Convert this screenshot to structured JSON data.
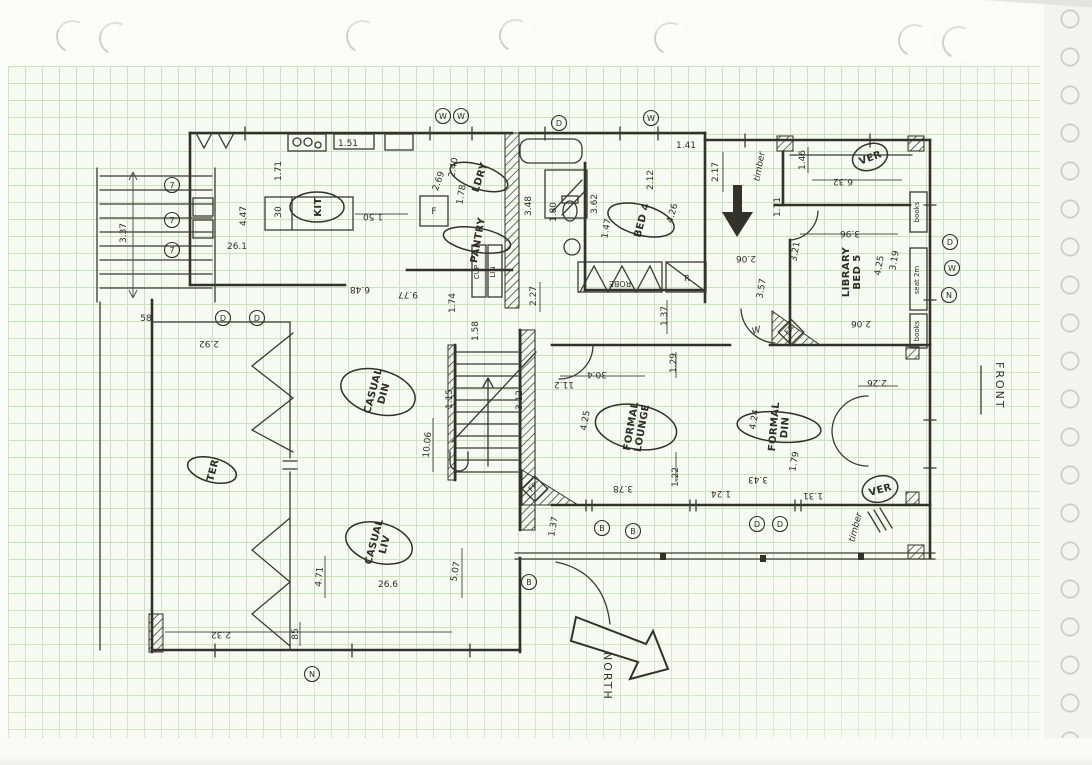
{
  "colors": {
    "ink": "#32322b",
    "grid_line": "#c9e4bc",
    "paper": "#fbfbf8"
  },
  "annotations": {
    "front": "FRONT",
    "north": "NORTH"
  },
  "rooms": [
    {
      "label": "KIT",
      "x": 317,
      "y": 207,
      "r": -90,
      "ellipse": [
        15,
        27
      ]
    },
    {
      "label": "LDRY",
      "x": 479,
      "y": 177,
      "r": -72,
      "ellipse": [
        12,
        30
      ]
    },
    {
      "label": "PANTRY",
      "x": 477,
      "y": 240,
      "r": -80,
      "ellipse": [
        12,
        34
      ]
    },
    {
      "label": "BED 4",
      "x": 641,
      "y": 220,
      "r": -75,
      "ellipse": [
        15,
        34
      ]
    },
    {
      "lines": [
        "LIBRARY",
        "BED 5"
      ],
      "x": 851,
      "y": 272,
      "r": -90
    },
    {
      "label": "VER",
      "x": 870,
      "y": 157,
      "r": -20,
      "ellipse": [
        18,
        13
      ]
    },
    {
      "label": "TER",
      "x": 212,
      "y": 470,
      "r": -75,
      "ellipse": [
        12,
        25
      ]
    },
    {
      "lines": [
        "CASUAL",
        "DIN"
      ],
      "x": 378,
      "y": 392,
      "r": -75,
      "ellipse": [
        22,
        38
      ]
    },
    {
      "lines": [
        "CASUAL",
        "LIV"
      ],
      "x": 379,
      "y": 543,
      "r": -75,
      "ellipse": [
        20,
        34
      ]
    },
    {
      "lines": [
        "FORMAL",
        "LOUNGE"
      ],
      "x": 636,
      "y": 427,
      "r": -80,
      "ellipse": [
        22,
        41
      ]
    },
    {
      "lines": [
        "FORMAL",
        "DIN"
      ],
      "x": 779,
      "y": 427,
      "r": -85,
      "ellipse": [
        15,
        42
      ]
    },
    {
      "label": "VER",
      "x": 880,
      "y": 489,
      "r": -15,
      "ellipse": [
        18,
        13
      ]
    }
  ],
  "fixtures": [
    {
      "t": "F",
      "x": 434,
      "y": 214,
      "r": 0,
      "s": 9
    },
    {
      "t": "CUP",
      "x": 479,
      "y": 272,
      "r": -90,
      "s": 7
    },
    {
      "t": "LIN",
      "x": 495,
      "y": 272,
      "r": -90,
      "s": 7
    },
    {
      "t": "ROBE",
      "x": 620,
      "y": 281,
      "r": 180,
      "s": 8
    },
    {
      "t": "R.",
      "x": 688,
      "y": 281,
      "r": 0,
      "s": 8
    },
    {
      "t": "books",
      "x": 919,
      "y": 212,
      "r": -90,
      "s": 7
    },
    {
      "t": "seat 2m",
      "x": 919,
      "y": 280,
      "r": -90,
      "s": 7
    },
    {
      "t": "books",
      "x": 919,
      "y": 331,
      "r": -90,
      "s": 7
    },
    {
      "t": "FP",
      "x": 535,
      "y": 489,
      "r": -45,
      "s": 8
    },
    {
      "t": "FP",
      "x": 791,
      "y": 332,
      "r": -45,
      "s": 8
    },
    {
      "t": "W",
      "x": 757,
      "y": 333,
      "r": -15,
      "s": 9,
      "i": 1
    },
    {
      "t": "timber",
      "x": 762,
      "y": 167,
      "r": -80,
      "s": 9,
      "i": 1
    },
    {
      "t": "timber",
      "x": 858,
      "y": 528,
      "r": -75,
      "s": 9,
      "i": 1
    }
  ],
  "dimensions": [
    {
      "v": "1.51",
      "x": 348,
      "y": 146,
      "r": 0
    },
    {
      "v": "1.71",
      "x": 281,
      "y": 171,
      "r": -90
    },
    {
      "v": "4.47",
      "x": 246,
      "y": 216,
      "r": -90
    },
    {
      "v": "30",
      "x": 281,
      "y": 212,
      "r": -90
    },
    {
      "v": "1.50",
      "x": 373,
      "y": 214,
      "r": 180
    },
    {
      "v": "26.1",
      "x": 237,
      "y": 249,
      "r": 0
    },
    {
      "v": "3.37",
      "x": 126,
      "y": 233,
      "r": -90
    },
    {
      "v": "6.48",
      "x": 360,
      "y": 287,
      "r": 180
    },
    {
      "v": "9.77",
      "x": 408,
      "y": 292,
      "r": 180
    },
    {
      "v": "1.74",
      "x": 455,
      "y": 303,
      "r": -90
    },
    {
      "v": "1.58",
      "x": 478,
      "y": 331,
      "r": -90
    },
    {
      "v": "2.92",
      "x": 209,
      "y": 341,
      "r": 180
    },
    {
      "v": "58",
      "x": 146,
      "y": 321,
      "r": 0
    },
    {
      "v": "2.69",
      "x": 441,
      "y": 182,
      "r": -70
    },
    {
      "v": "1.78",
      "x": 464,
      "y": 195,
      "r": -80
    },
    {
      "v": "2.40",
      "x": 456,
      "y": 168,
      "r": -80
    },
    {
      "v": "3.48",
      "x": 531,
      "y": 206,
      "r": -90
    },
    {
      "v": "1.80",
      "x": 556,
      "y": 212,
      "r": -90
    },
    {
      "v": "3.62",
      "x": 597,
      "y": 204,
      "r": -90
    },
    {
      "v": "1.47",
      "x": 609,
      "y": 229,
      "r": -80
    },
    {
      "v": "2.12",
      "x": 653,
      "y": 180,
      "r": -90
    },
    {
      "v": "2.17",
      "x": 718,
      "y": 172,
      "r": -90
    },
    {
      "v": "4.26",
      "x": 675,
      "y": 214,
      "r": -75
    },
    {
      "v": "1.41",
      "x": 686,
      "y": 148,
      "r": 0
    },
    {
      "v": "1.46",
      "x": 805,
      "y": 160,
      "r": -90
    },
    {
      "v": "6.32",
      "x": 843,
      "y": 179,
      "r": 180
    },
    {
      "v": "1.71",
      "x": 780,
      "y": 207,
      "r": -90
    },
    {
      "v": "3.96",
      "x": 850,
      "y": 231,
      "r": 180
    },
    {
      "v": "3.21",
      "x": 798,
      "y": 252,
      "r": -80
    },
    {
      "v": "3.57",
      "x": 764,
      "y": 289,
      "r": -80
    },
    {
      "v": "2.06",
      "x": 746,
      "y": 256,
      "r": 180
    },
    {
      "v": "2.06",
      "x": 861,
      "y": 321,
      "r": 180
    },
    {
      "v": "4.25",
      "x": 882,
      "y": 266,
      "r": -80
    },
    {
      "v": "3.19",
      "x": 897,
      "y": 261,
      "r": -80
    },
    {
      "v": "2.27",
      "x": 536,
      "y": 296,
      "r": -90
    },
    {
      "v": "1.37",
      "x": 667,
      "y": 316,
      "r": -90
    },
    {
      "v": "3.12",
      "x": 522,
      "y": 400,
      "r": -90
    },
    {
      "v": "4.25",
      "x": 588,
      "y": 421,
      "r": -80
    },
    {
      "v": "10.06",
      "x": 430,
      "y": 445,
      "r": -85
    },
    {
      "v": "1.15",
      "x": 452,
      "y": 399,
      "r": -90
    },
    {
      "v": "30.4",
      "x": 597,
      "y": 372,
      "r": 180
    },
    {
      "v": "11.2",
      "x": 564,
      "y": 382,
      "r": 180
    },
    {
      "v": "1.29",
      "x": 676,
      "y": 363,
      "r": -90
    },
    {
      "v": "1.22",
      "x": 678,
      "y": 477,
      "r": -90
    },
    {
      "v": "4.24",
      "x": 757,
      "y": 420,
      "r": -80
    },
    {
      "v": "1.79",
      "x": 797,
      "y": 462,
      "r": -80
    },
    {
      "v": "3.43",
      "x": 758,
      "y": 477,
      "r": 180
    },
    {
      "v": "3.78",
      "x": 623,
      "y": 486,
      "r": 180
    },
    {
      "v": "1.24",
      "x": 721,
      "y": 491,
      "r": 180
    },
    {
      "v": "1.31",
      "x": 813,
      "y": 493,
      "r": 180
    },
    {
      "v": "2.26",
      "x": 877,
      "y": 380,
      "r": 180
    },
    {
      "v": "1.37",
      "x": 556,
      "y": 527,
      "r": -80
    },
    {
      "v": "5.07",
      "x": 458,
      "y": 572,
      "r": -80
    },
    {
      "v": "26.6",
      "x": 388,
      "y": 587,
      "r": 0
    },
    {
      "v": "4.71",
      "x": 322,
      "y": 577,
      "r": -85
    },
    {
      "v": "85",
      "x": 298,
      "y": 634,
      "r": -90
    },
    {
      "v": "2.32",
      "x": 221,
      "y": 632,
      "r": 180
    }
  ],
  "markers": [
    {
      "t": "7",
      "x": 172,
      "y": 185
    },
    {
      "t": "7",
      "x": 172,
      "y": 220
    },
    {
      "t": "7",
      "x": 172,
      "y": 250
    },
    {
      "t": "W",
      "x": 443,
      "y": 116
    },
    {
      "t": "W",
      "x": 461,
      "y": 116
    },
    {
      "t": "D",
      "x": 559,
      "y": 123
    },
    {
      "t": "W",
      "x": 651,
      "y": 118
    },
    {
      "t": "D",
      "x": 223,
      "y": 318
    },
    {
      "t": "D",
      "x": 257,
      "y": 318
    },
    {
      "t": "B",
      "x": 602,
      "y": 528
    },
    {
      "t": "B",
      "x": 633,
      "y": 531
    },
    {
      "t": "D",
      "x": 757,
      "y": 524
    },
    {
      "t": "D",
      "x": 780,
      "y": 524
    },
    {
      "t": "D",
      "x": 950,
      "y": 242
    },
    {
      "t": "W",
      "x": 952,
      "y": 268
    },
    {
      "t": "N",
      "x": 949,
      "y": 295
    },
    {
      "t": "N",
      "x": 312,
      "y": 674
    },
    {
      "t": "B",
      "x": 529,
      "y": 582
    }
  ]
}
